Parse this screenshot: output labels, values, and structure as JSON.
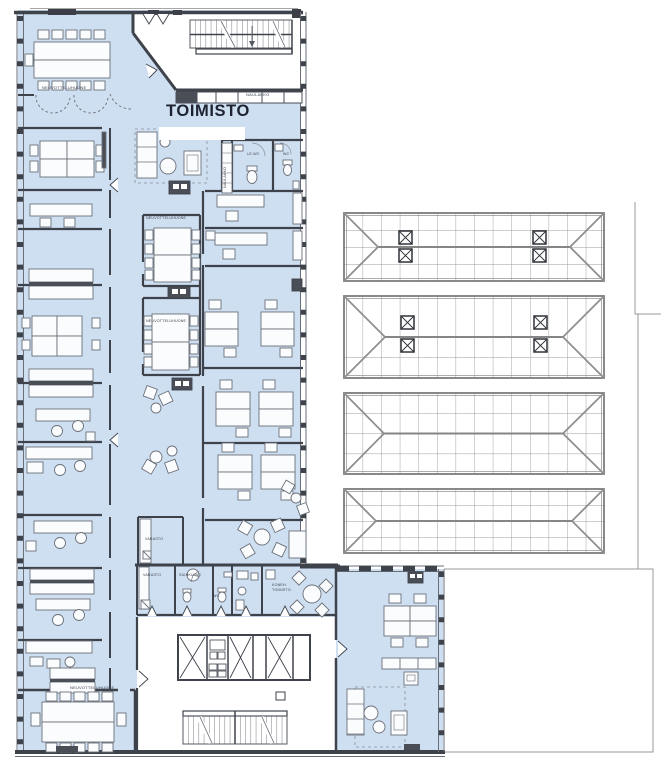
{
  "document": {
    "type": "architectural-floor-plan",
    "building_use": "office"
  },
  "labels": {
    "title": "TOIMISTO",
    "meeting_room_top_left": "NEUVOTTELUHUONE",
    "coat_rack_top": "NAULAKKO",
    "coat_rack_side": "NAULAKKO",
    "wc_accessible": "LE-WC",
    "wc_upper": "WC",
    "meeting_room_mid_1": "NEUVOTTELUHUONE",
    "meeting_room_mid_2": "NEUVOTTELUHUONE",
    "storage_upper": "VARASTO",
    "storage_lower": "VARASTO",
    "shower_wc": "SUIHKU/WC",
    "wc_lower": "WC",
    "small_office_line1": "KONEH.",
    "small_office_line2": "TOIMISTO",
    "meeting_room_bottom": "NEUVOTTELUHUONE"
  },
  "colors": {
    "floor_fill": "#cfdff2",
    "wall": "#3e424b",
    "furniture_stroke": "#6b7078",
    "dark_fixture": "#4a4e57",
    "roof_line": "#909090",
    "site_line": "#9a9a9a",
    "title_color": "#1d2230"
  }
}
